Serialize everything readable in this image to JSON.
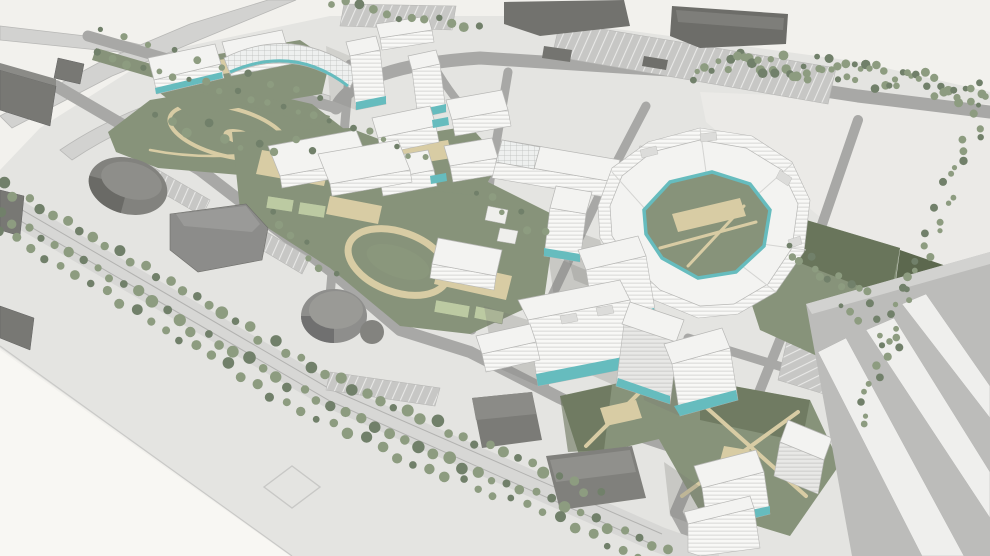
{
  "meta": {
    "type": "3d-architectural-masterplan-aerial-render",
    "view": "aerial-oblique",
    "canvas": {
      "width": 990,
      "height": 556
    }
  },
  "palette": {
    "bg": "#f2f1ed",
    "bg_light": "#f8f7f3",
    "plane": "#e4e4e1",
    "field": "#ebeae7",
    "road": "#a8a8a6",
    "road_light": "#c9c9c7",
    "boulevard": "#d7d7d5",
    "lane": "#b2b2b0",
    "lawn": "#87937a",
    "lawn_dark": "#5c684e",
    "lawn_light": "#bccaa2",
    "sand": "#d8cca4",
    "sand_dark": "#c9bc94",
    "roof": "#f3f3f1",
    "line": "#b7b7b5",
    "facade_a": "#f8f8f6",
    "facade_b": "#dadad8",
    "facade_sh_a": "#e8e8e6",
    "facade_sh_b": "#cfcfcd",
    "teal": "#66bcbe",
    "teal_dark": "#3f9598",
    "industrial": "#787874",
    "industrial_roof": "#8b8b87",
    "industrial_dark": "#616160",
    "tree": "#8d9c80",
    "tree_dark": "#71806a",
    "shadow": "#787874",
    "ramp_base": "#bcbcba",
    "ramp_white": "#efefed",
    "grid_base": "#eef0ef",
    "grid_line": "#b9bcba",
    "park_base": "#c7c7c5",
    "park_line": "#e9e9e7"
  },
  "scene": {
    "elements": [
      "highway-interchange",
      "arterial-road",
      "tree-lined-boulevard",
      "residential-cluster-northwest",
      "curved-glass-arc-building",
      "residential-cluster-center",
      "curved-perimeter-block",
      "residential-cluster-south",
      "residential-cluster-southeast",
      "school-building",
      "sports-track",
      "kindergarten",
      "city-park",
      "industrial-warehouses",
      "retail-pavilions",
      "parking-lots",
      "tree-rows",
      "green-courtyards",
      "highway-ramps-southeast"
    ]
  }
}
